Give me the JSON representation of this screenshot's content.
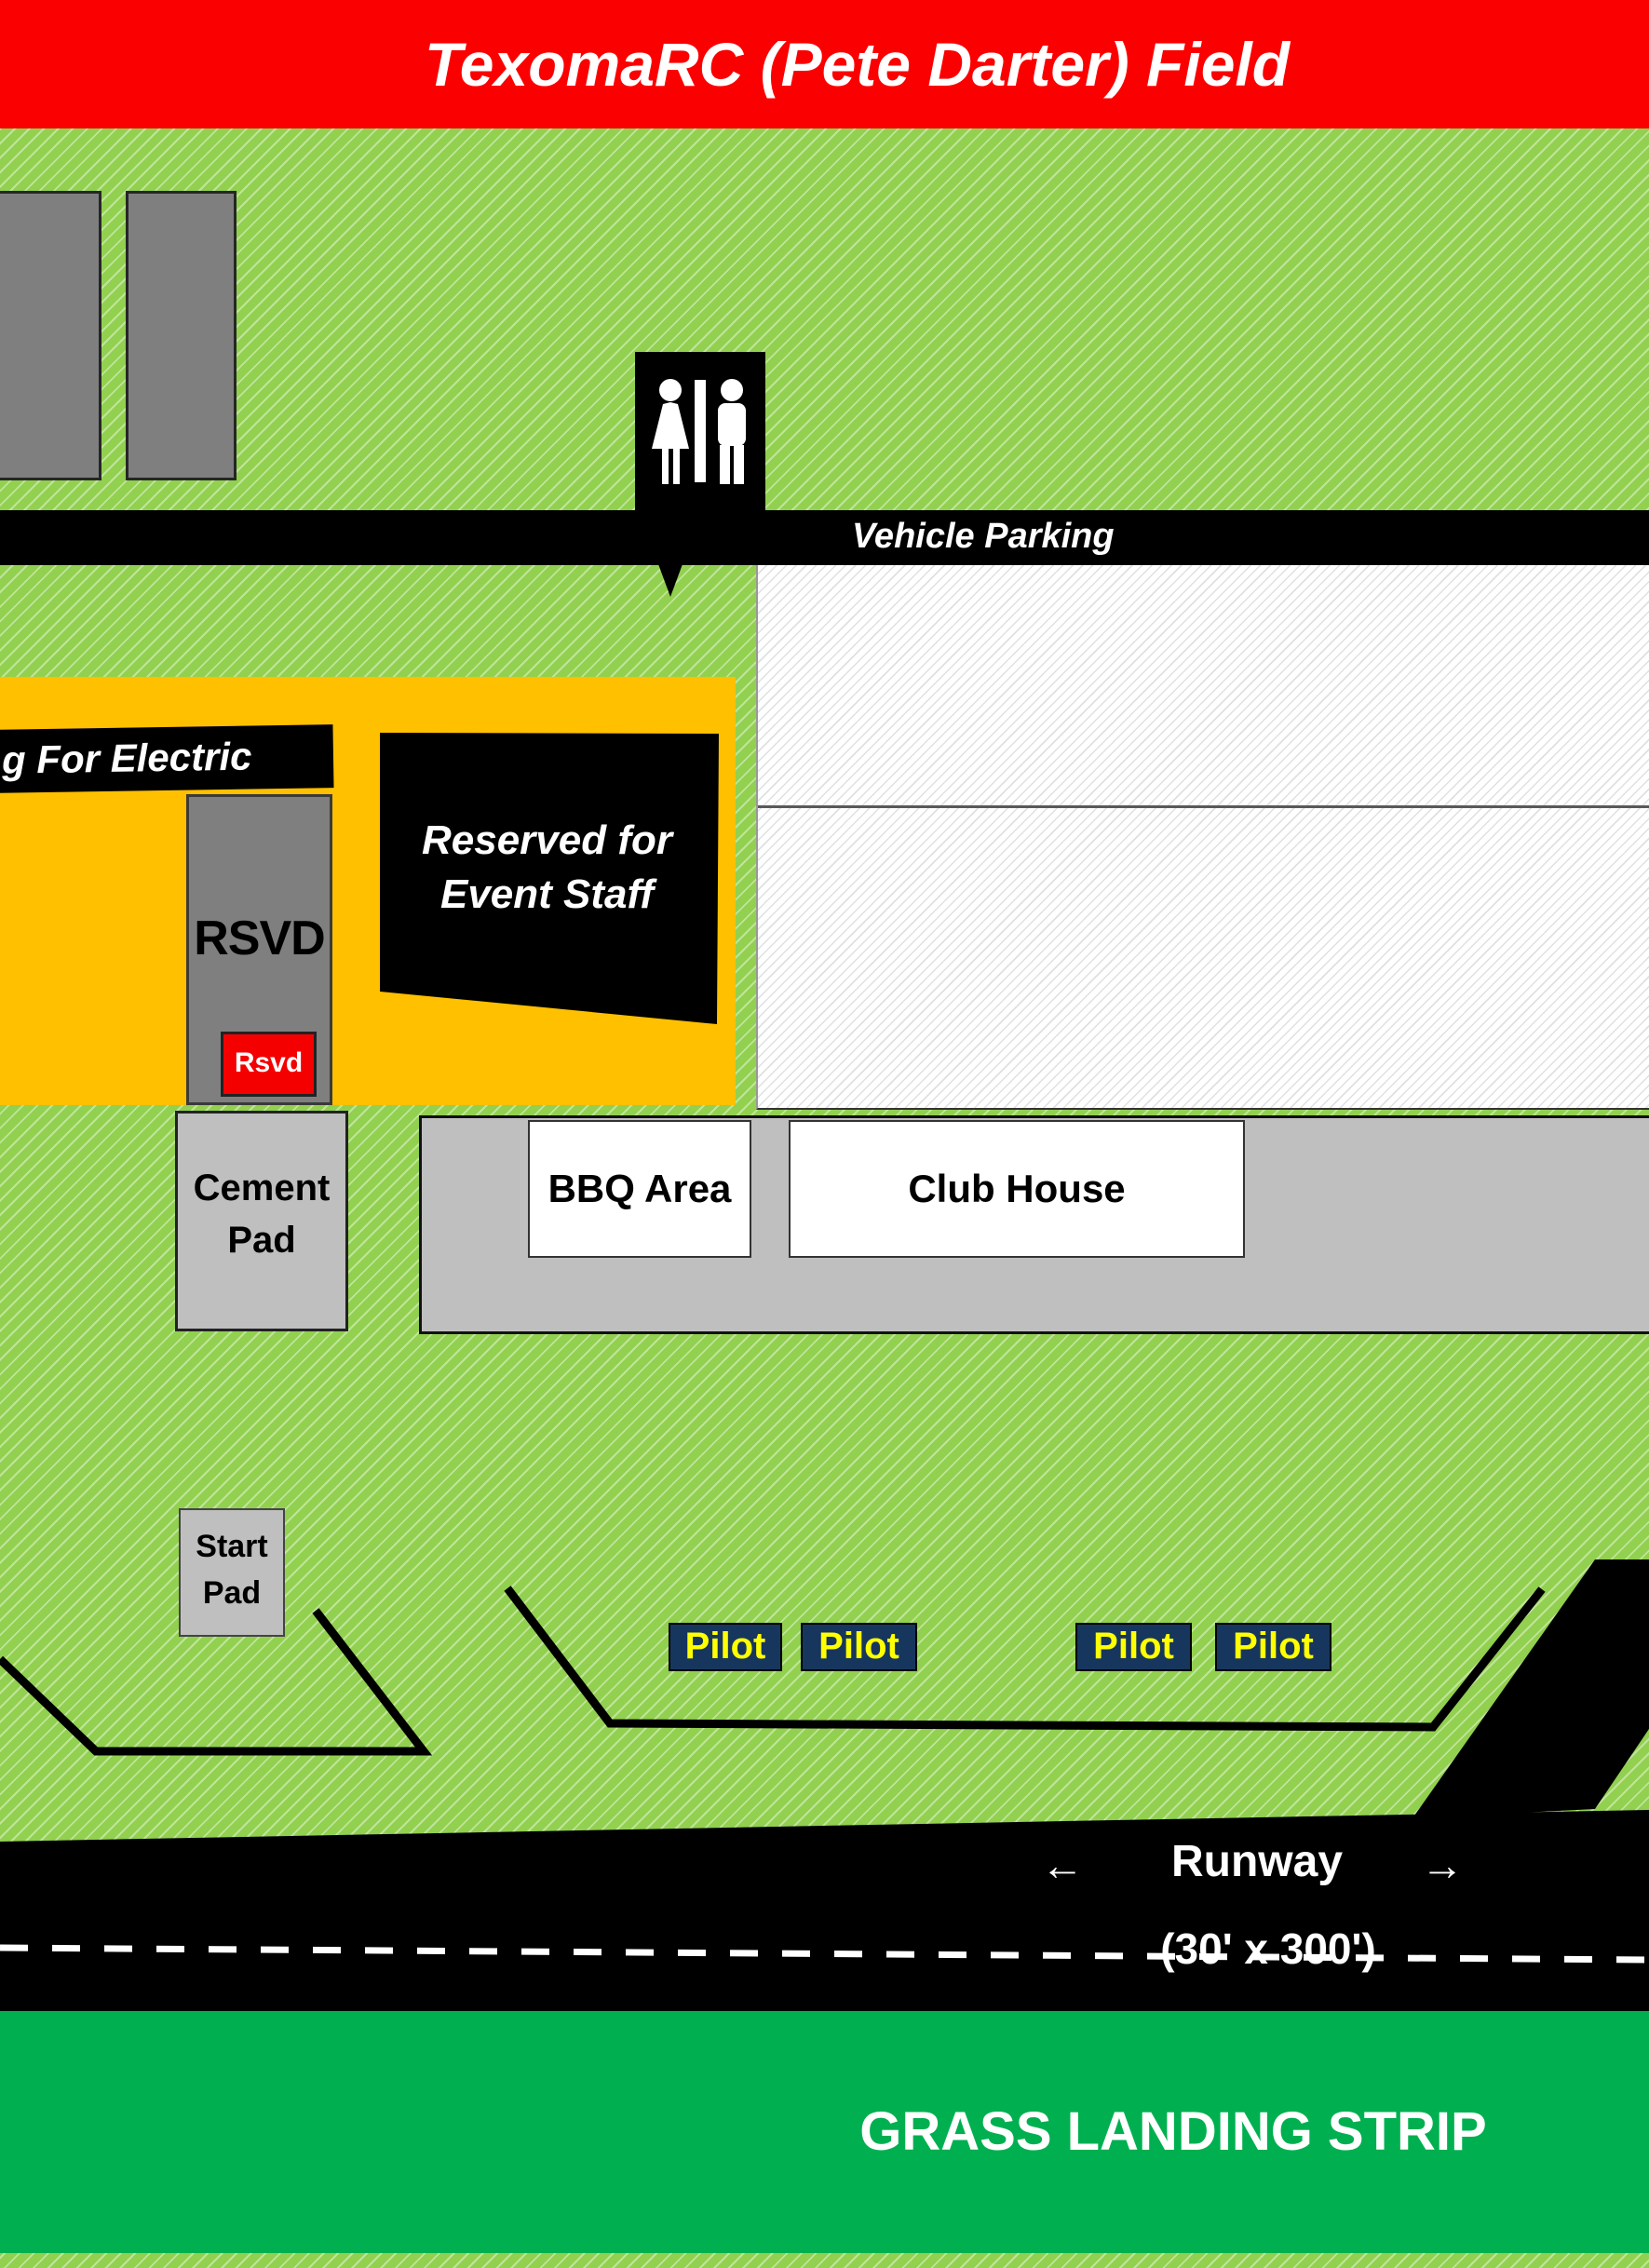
{
  "header": {
    "title": "TexomaRC (Pete Darter) Field"
  },
  "signs": {
    "vehicle_parking": "Vehicle Parking",
    "electric": "g For Electric",
    "reserved": {
      "line1": "Reserved for",
      "line2": "Event Staff"
    },
    "rsvd_big": "RSVD",
    "rsvd_small": "Rsvd"
  },
  "buildings": {
    "bbq": "BBQ Area",
    "club_house": "Club House",
    "cement_pad": {
      "line1": "Cement",
      "line2": "Pad"
    },
    "start_pad": {
      "line1": "Start",
      "line2": "Pad"
    }
  },
  "pilots": [
    {
      "label": "Pilot"
    },
    {
      "label": "Pilot"
    },
    {
      "label": "Pilot"
    },
    {
      "label": "Pilot"
    }
  ],
  "runway": {
    "label": "Runway",
    "dimensions": "(30' x 300')",
    "left_arrow": "←",
    "right_arrow": "→"
  },
  "grass_strip": {
    "label": "GRASS LANDING STRIP"
  },
  "icons": {
    "restroom_sign": "woman-man-restroom-pictogram"
  },
  "colors": {
    "field_green": "#92D050",
    "grass_green": "#00B050",
    "electric_orange": "#FFC000",
    "header_red": "#FB0000",
    "rsvd_red": "#F40000",
    "pilot_navy": "#17365D",
    "pilot_yellow": "#FFFF00",
    "pad_gray": "#BFBFBF",
    "stall_gray": "#7F7F7F"
  }
}
